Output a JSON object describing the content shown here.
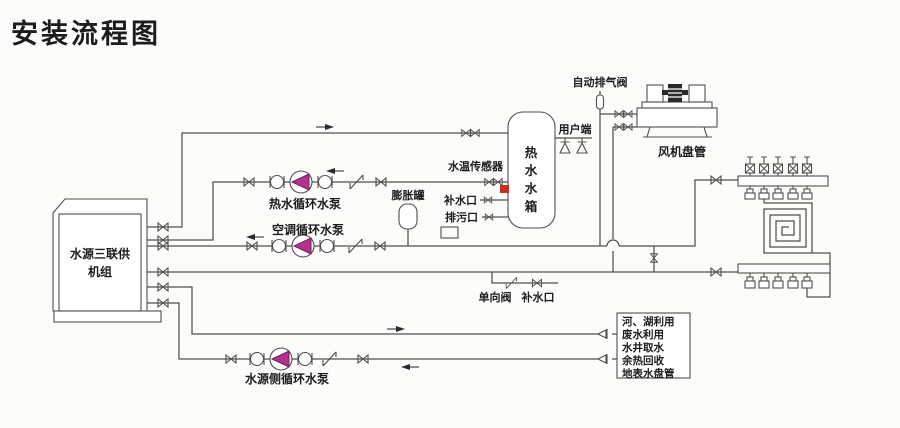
{
  "title": "安装流程图",
  "colors": {
    "title_green": "#1d9a2d",
    "pump_magenta": "#b5308f",
    "pump_edge": "#6d1f5c",
    "sensor_red": "#c03425",
    "sensor_label": "#8a4530",
    "line": "#4f4f4d"
  },
  "unit": {
    "line1": "水源三联供",
    "line2": "机组"
  },
  "tank": {
    "chars": [
      "热",
      "水",
      "水",
      "箱"
    ]
  },
  "labels": {
    "hot_pump": "热水循环水泵",
    "ac_pump": "空调循环水泵",
    "source_pump": "水源侧循环水泵",
    "expansion_tank": "膨胀罐",
    "temp_sensor": "水温传感器",
    "makeup_port_tank": "补水口",
    "drain_port": "排污口",
    "check_valve": "单向阀",
    "makeup_port_line": "补水口",
    "user_end": "用户端",
    "auto_vent": "自动排气阀",
    "fan_coil": "风机盘管"
  },
  "source_box": {
    "items": [
      "河、湖利用",
      "废水利用",
      "水井取水",
      "余热回收",
      "地表水盘管"
    ]
  }
}
